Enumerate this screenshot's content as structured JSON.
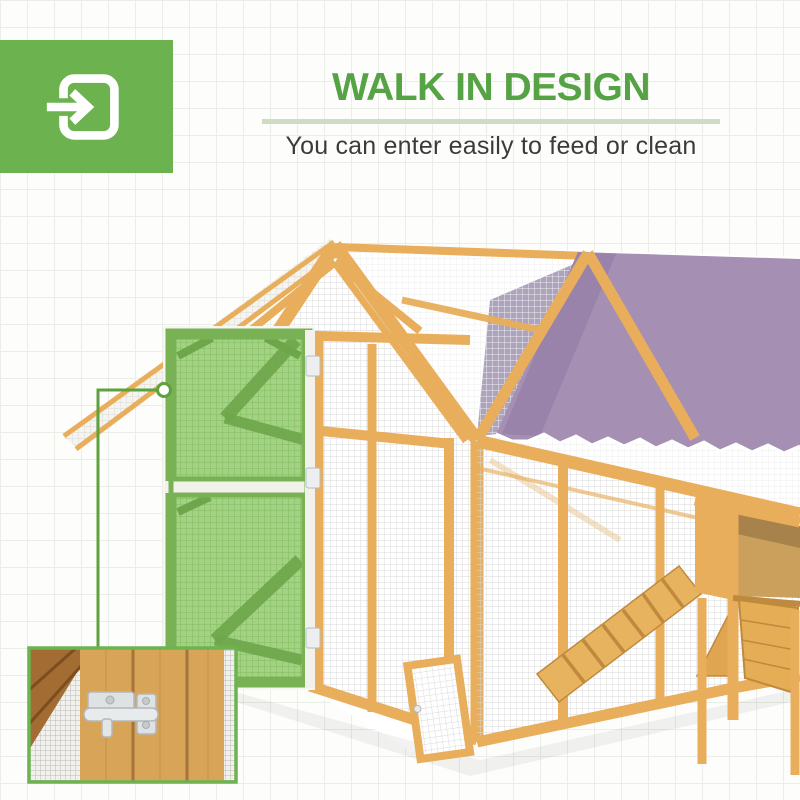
{
  "header": {
    "title": "WALK IN DESIGN",
    "subtitle": "You can enter easily to feed or clean"
  },
  "badge": {
    "icon": "enter-arrow-icon"
  },
  "scene": {
    "illustration": "walk-in-chicken-coop",
    "highlighted_part": "open-mesh-door",
    "inset": "door-latch-closeup",
    "roof_cover": "purple-tarp-roof",
    "interior_feature": "chicken-ramp",
    "callout": "leader-line-with-circle"
  },
  "theme": {
    "badge_bg": "#6cb24e",
    "title": "#55a344",
    "underline": "#cddcc3",
    "subtitle_text": "#3b3b3b",
    "accent": "#5ea23e",
    "wood": "#e8ae5b",
    "wood_dark": "#c08a3e",
    "tarp": "#a58fb3",
    "door_green": "#a3d284",
    "door_green_frame": "#79b254",
    "metal": "#dfe2e3",
    "inset_border": "#6db34f"
  }
}
